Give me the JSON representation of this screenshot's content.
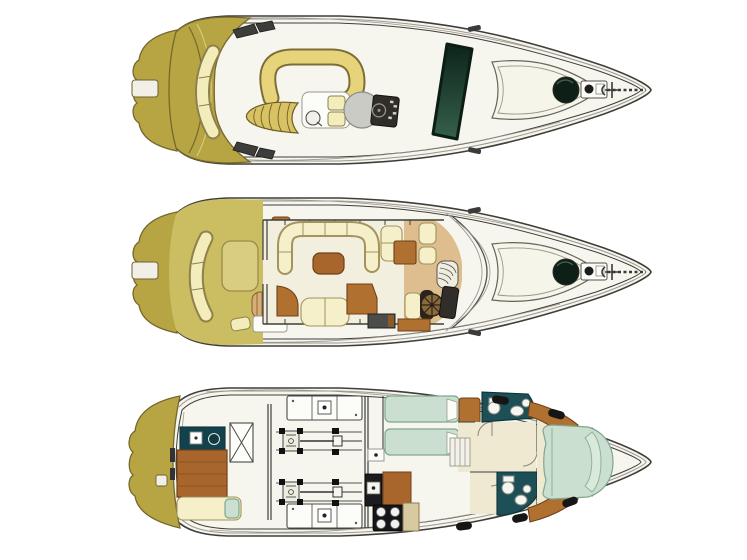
{
  "image": {
    "alt": "Three-deck top-view floor plans of a motor yacht stacked vertically on white: flybridge, main deck, lower deck"
  },
  "decks": [
    {
      "id": "flybridge",
      "name": "flybridge-deck-plan"
    },
    {
      "id": "main-deck",
      "name": "main-deck-plan"
    },
    {
      "id": "lower-deck",
      "name": "lower-deck-plan"
    }
  ],
  "colors": {
    "line": "#3f3e39",
    "line-soft": "#9b988f",
    "hull": "#f6f5ee",
    "ivory": "#f2efdf",
    "ivory2": "#efe9d2",
    "olive": "#b7a544",
    "olive-edge": "#75682c",
    "khaki": "#cbbd62",
    "khaki-light": "#d9cd7f",
    "pale": "#f3ecbb",
    "pale-edge": "#8f814a",
    "settee": "#e7d47a",
    "settee-edge": "#7c6e35",
    "cream": "#f5efca",
    "cream-edge": "#a3935c",
    "brown": "#a9662c",
    "wood": "#b0702f",
    "brown-edge": "#6e4118",
    "tan": "#debd8f",
    "glass-dark": "#0c241b",
    "glass-light": "#36604a",
    "disc": "#cbcbc5",
    "console": "#312d28",
    "teal": "#1d4f57",
    "teal-edge": "#0d3038",
    "teal-counter": "#14424c",
    "mint": "#cbdfd0",
    "mint-edge": "#7fa78f",
    "mint-light": "#d9e9dc",
    "module": "#fcfcf8",
    "black": "#161616",
    "stripe-bg": "#d8c263",
    "stripe-edge": "#6b5d2a",
    "roll": "#d6ae78",
    "roll-edge": "#8a5f33",
    "gray-dark": "#3d3d3b"
  }
}
